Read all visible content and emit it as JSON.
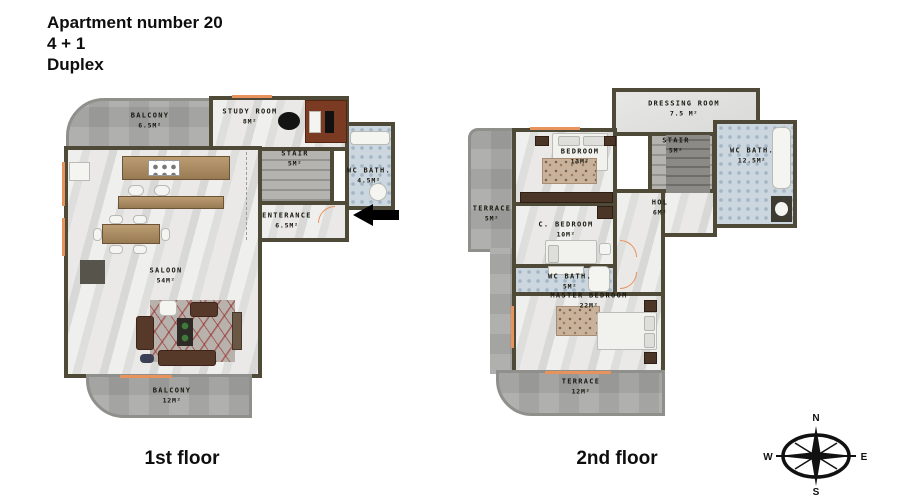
{
  "title": {
    "line1": "Apartment number 20",
    "line2": "4 + 1",
    "line3": "Duplex"
  },
  "floor1": {
    "caption": "1st floor",
    "rooms": [
      {
        "name": "BALCONY",
        "area": "6.5M²"
      },
      {
        "name": "STUDY ROOM",
        "area": "8M²"
      },
      {
        "name": "STAIR",
        "area": "5M²"
      },
      {
        "name": "WC BATH.",
        "area": "4.5M²"
      },
      {
        "name": "ENTERANCE",
        "area": "6.5M²"
      },
      {
        "name": "SALOON",
        "area": "54M²"
      },
      {
        "name": "BALCONY",
        "area": "12M²"
      }
    ]
  },
  "floor2": {
    "caption": "2nd floor",
    "rooms": [
      {
        "name": "DRESSING ROOM",
        "area": "7.5 M²"
      },
      {
        "name": "STAIR",
        "area": "5M²"
      },
      {
        "name": "WC BATH.",
        "area": "12.5M²"
      },
      {
        "name": "BEDROOM",
        "area": "13M²"
      },
      {
        "name": "TERRACE",
        "area": "5M²"
      },
      {
        "name": "C. BEDROOM",
        "area": "10M²"
      },
      {
        "name": "HOL",
        "area": "6M²"
      },
      {
        "name": "WC BATH.",
        "area": "5M²"
      },
      {
        "name": "MASTER BEDROOM",
        "area": "22M²"
      },
      {
        "name": "TERRACE",
        "area": "12M²"
      }
    ]
  },
  "compass": {
    "n": "N",
    "e": "E",
    "s": "S",
    "w": "W"
  },
  "colors": {
    "wall": "#4f4a38",
    "floor_marble": "#e6e6e4",
    "bath_tile": "#ccd6de",
    "wood": "#ab8d65",
    "terrace": "#b0b0ae",
    "window_accent": "#e8935c",
    "wardrobe": "#7b3b22",
    "sofa": "#57392a",
    "arrow": "#000000"
  }
}
